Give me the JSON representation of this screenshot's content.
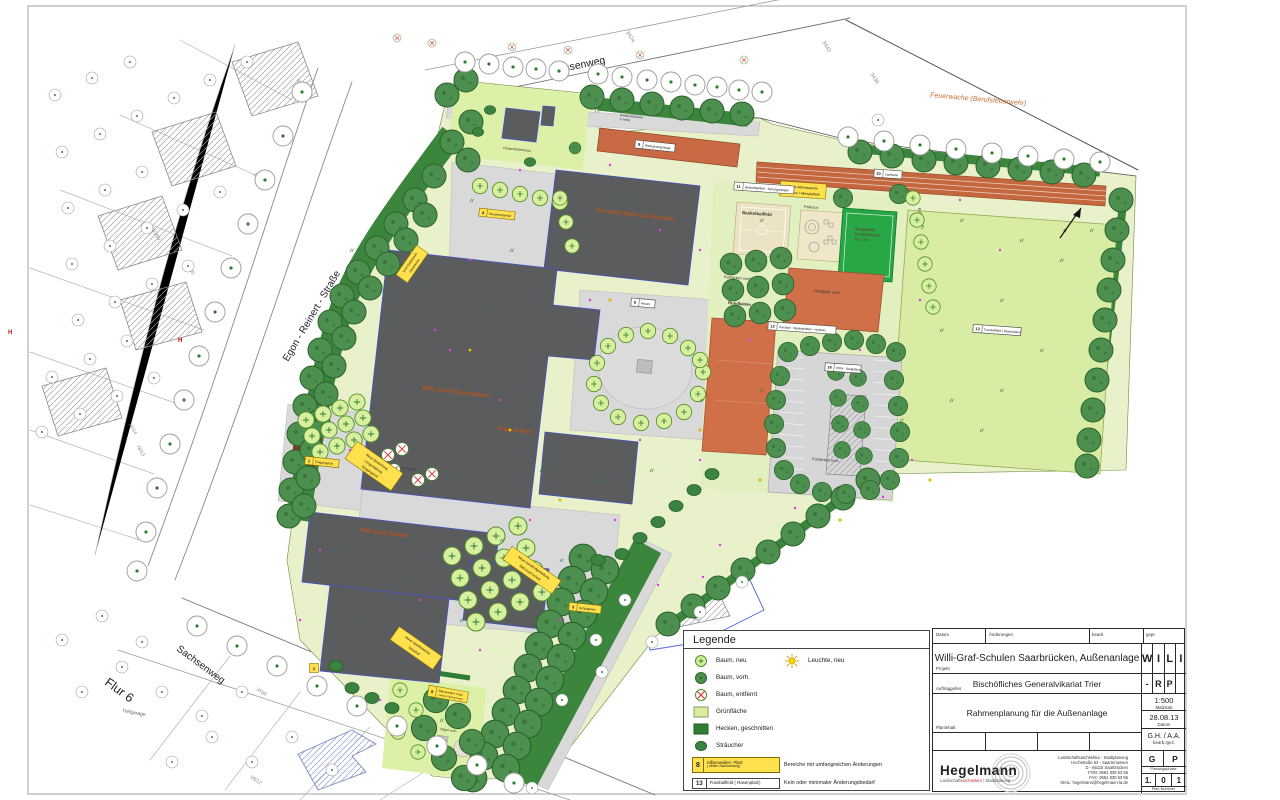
{
  "map": {
    "streets": {
      "hessenweg": "Hessenweg",
      "egon_reinert": "Egon - Reinert - Straße",
      "sachsenweg": "Sachsenweg",
      "flur": "Flur 6",
      "tiefgarage": "Tiefgarage",
      "feuerwache": "Feuerwache (Berufsfeuerwehr)"
    },
    "buildings": {
      "turnhalle": "Turnhalle Willi-Graf-Schulen",
      "gymnasium": "Willi-Graf-Gymnasium",
      "pausenhoefe": "Pausenhöfe",
      "schule": "Willi-Graf-Schule",
      "hausmeisterhaus": "Hausmeisterhaus",
      "kindergarten": "Städt. Kindergarten"
    },
    "labels": {
      "basketballfeld": "Basketballfeld",
      "parkour": "Parkour",
      "mini1": "Minispielfeld",
      "mini2": "Kunststoffrasen",
      "mini3": "20 x 13 m",
      "kastanien1": "Kastanien vorh.",
      "kastanien2": "Kastanien vorh.",
      "rundbaenke": "Rundbänke",
      "hartplatz": "Hartplatz vorh.",
      "eichen": "Eichen vorh.",
      "brunnen": "Brunnen vorh.",
      "huegel": "Hügel vorh.",
      "bestand1": "Bestandsbäume",
      "bestand2": "2-zeilig"
    },
    "parcels": {
      "p3424": "3424",
      "p3432": "3432",
      "p3436": "3436",
      "p3443": "3443",
      "p3438": "3438",
      "p322": "322/85",
      "p203": "203/59",
      "p172": "172/54",
      "p45": "45/8",
      "p76": "76/14",
      "p78": "78/13",
      "p98": "98/12"
    },
    "hydrant": "H",
    "north": "N",
    "callouts": {
      "c1a": "Neue Aktionssporte",
      "c1b": "Parkour / Minispielfeld",
      "c2a": "Neue Bestuhlung",
      "c2b": "Umgestaltung",
      "c2c": "Eingangshof",
      "c3a": "Neue Schulhofgestaltung",
      "c3b": "Willi-Graf-Schule",
      "c4a": "Neue Spielbereiche",
      "c4b": "Schulhof",
      "c5a": "Insel Nadelbaum",
      "c5b": "Obstbäume"
    },
    "boxes": {
      "b1": {
        "num": "1",
        "text": "Eingangshof"
      },
      "b2": {
        "num": "2",
        "text": ""
      },
      "b3": {
        "num": "3",
        "text": "Schulgarten"
      },
      "b4": {
        "num": "4",
        "text": "Hausmeisterhof"
      },
      "b5": {
        "num": "5",
        "text": "Atrium"
      },
      "b8": {
        "num": "8",
        "text1": "Silberweiden- Platz",
        "text2": "( neben Sachsenweg)"
      },
      "b9": {
        "num": "9",
        "text": "Weitsprunganlage"
      },
      "b10": {
        "num": "10",
        "text": "Laufbahn"
      },
      "b11": {
        "num": "11",
        "text": "Basketballfeld - Sprunganlagen"
      },
      "b12": {
        "num": "12",
        "text": "Handball- / Basketballfeld - Hartplatz"
      },
      "b13": {
        "num": "13",
        "text": "Fussballfeld  ( Rasenplatz)"
      },
      "b14": {
        "num": "14",
        "text": "PKW - Stellplätze"
      }
    }
  },
  "legend": {
    "title": "Legende",
    "items": [
      {
        "label": "Baum, neu"
      },
      {
        "label": "Baum, vorh."
      },
      {
        "label": "Baum, entfernt"
      },
      {
        "label": "Grünfläche"
      },
      {
        "label": "Hecken, geschnitten"
      },
      {
        "label": "Sträucher"
      }
    ],
    "light_label": "Leuchte, neu",
    "change_rows": [
      {
        "num": "8",
        "line1": "Silberweiden- Platz",
        "line2": "( neben Sachsenweg)",
        "desc": "Bereiche mit umfangreichen Änderungen"
      },
      {
        "num": "13",
        "line1": "Fussballfeld  ( Rasenplatz)",
        "desc": "Kein oder minimaler Änderungsbedarf"
      }
    ]
  },
  "titleblock": {
    "col_datum": "Datum",
    "col_aend": "Änderungen",
    "col_bearb": "bearb.",
    "col_gepr": "gepr.",
    "projekt_label": "Projekt",
    "projekt": "Willi-Graf-Schulen Saarbrücken, Außenanlage",
    "code1": [
      "W",
      "I",
      "L",
      "I"
    ],
    "auftraggeber_label": "Auftraggeber",
    "auftraggeber": "Bischöfliches Generalvikariat Trier",
    "code2": [
      "-",
      "R",
      "P",
      ""
    ],
    "planinhalt_label": "Planinhalt",
    "planinhalt": "Rahmenplanung für die Außenanlage",
    "massstab": "1:500",
    "massstab_label": "Maßstab",
    "datum": "28.08.13",
    "datum_label": "Datum",
    "bearb": "G.H. / A.A.",
    "bearb_label": "bearb./gez.",
    "firm_name": "Hegelmann",
    "firm_sub1": "Landschafts",
    "firm_sub2": "architektur",
    "firm_sub3": "| Stadtplanung",
    "firm_line1": "Landschaftsarchitektur - Stadtplanung",
    "firm_addr1": "Hochstraße 63 - Saarterrassen",
    "firm_addr2": "D - 66115 Saarbrücken",
    "firm_fon": "FON: 0681 830 53 56",
    "firm_fax": "FAX: 0681 830 53 56",
    "firm_mail": "MAIL: hegelmann@hegelmann-la.de",
    "phase": [
      "G",
      "P"
    ],
    "phase_label": "Planungsphase",
    "plannr": [
      "1.",
      "0",
      "1"
    ],
    "plannr_label": "Plan-Nummer"
  }
}
